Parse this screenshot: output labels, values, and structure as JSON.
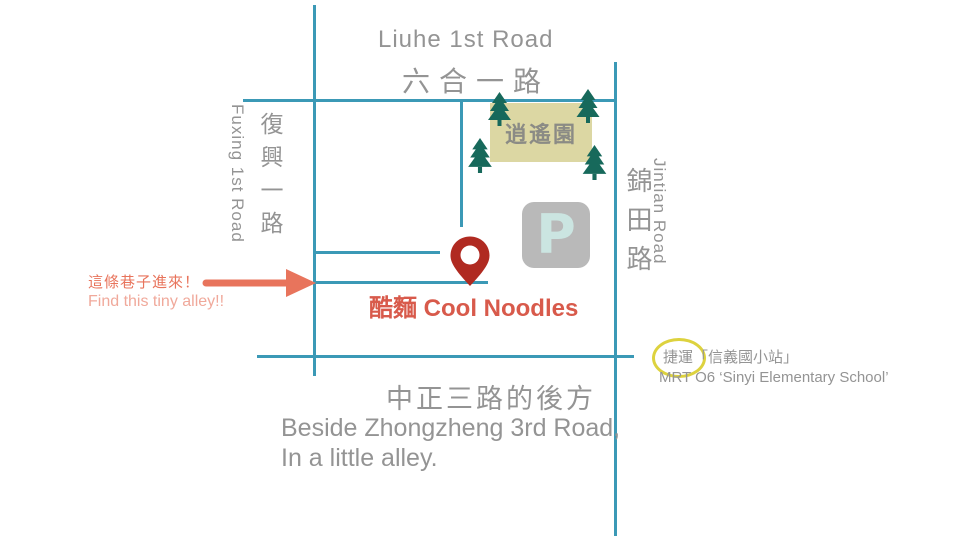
{
  "colors": {
    "road": "#3b99b6",
    "tree": "#17695b",
    "park_fill": "#dcd7a3",
    "pin": "#b02a21",
    "parking_bg": "#b9b9b9",
    "parking_letter": "#cbe5e1",
    "accent_salmon": "#e8745c",
    "accent_salmon_light": "#f0a99b",
    "destination_red": "#d85a4b",
    "mrt_circle_yellow": "#ddd23e",
    "text_gray": "#949494"
  },
  "roads": {
    "liuhe": {
      "en": "Liuhe 1st Road",
      "zh": "六合一路"
    },
    "fuxing": {
      "en": "Fuxing 1st Road",
      "zh": "復興一路"
    },
    "jintian": {
      "en": "Jintian Road",
      "zh": "錦田路"
    }
  },
  "park": {
    "name": "逍遙園"
  },
  "parking": {
    "letter": "P"
  },
  "destination": {
    "name": "酷麵 Cool Noodles"
  },
  "alley_note": {
    "zh": "這條巷子進來！",
    "en": "Find this tiny alley!!"
  },
  "bottom_note": {
    "zh": "中正三路的後方",
    "en_line1": "Beside Zhongzheng 3rd Road,",
    "en_line2": "In a little alley."
  },
  "mrt": {
    "zh": "捷運「信義國小站」",
    "en": "MRT O6 ‘Sinyi Elementary School’"
  }
}
